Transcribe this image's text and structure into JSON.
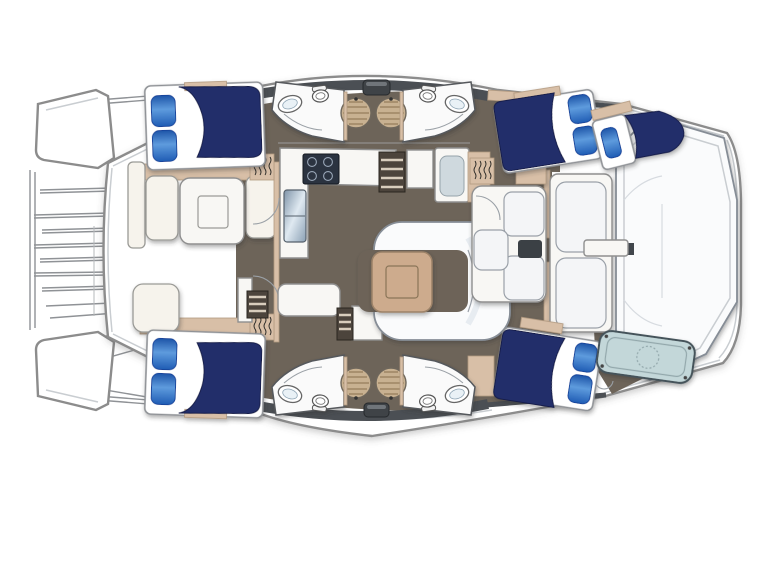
{
  "image": {
    "kind": "catamaran-deck-floor-plan",
    "width": 768,
    "height": 576,
    "background": "#ffffff",
    "orientation": "bow-left-stern-right"
  },
  "colors": {
    "outline_gray": "#8c8c8c",
    "inner_line": "#c9cdd1",
    "deck_band": "#4b4f54",
    "floor_taupe": "#6d6459",
    "wood_tan": "#d8bfa7",
    "table_tan": "#cdab8d",
    "bed_navy": "#232e6b",
    "pillow_blue": "#2f6fc4",
    "sofa_white": "#fafbfc",
    "shower_tan": "#c8b191",
    "steps_dark": "#4c443c",
    "stove_dark": "#2b3340",
    "tender_blue": "#c3d7d9",
    "cream": "#f6f3ec"
  },
  "areas": [
    {
      "id": "port-bow",
      "label": "port bow"
    },
    {
      "id": "starboard-bow",
      "label": "starboard bow"
    },
    {
      "id": "trampoline",
      "label": "bow trampoline"
    },
    {
      "id": "forward-cockpit",
      "label": "forward cockpit seating with table"
    },
    {
      "id": "galley",
      "label": "galley with stove, sink and fridge"
    },
    {
      "id": "dining-area",
      "label": "saloon dining with C-sofa and table"
    },
    {
      "id": "nav-seating",
      "label": "aft saloon seating"
    },
    {
      "id": "head-port-forward",
      "label": "bathroom port forward"
    },
    {
      "id": "head-starboard-forward",
      "label": "bathroom port aft"
    },
    {
      "id": "head-port-aft",
      "label": "bathroom starboard forward"
    },
    {
      "id": "head-starboard-aft",
      "label": "bathroom starboard aft"
    },
    {
      "id": "bed-forward-port",
      "label": "forward cabin berth (top left)"
    },
    {
      "id": "bed-forward-starboard",
      "label": "forward cabin berth (bottom left)"
    },
    {
      "id": "bed-aft-port",
      "label": "aft cabin berth (top right)"
    },
    {
      "id": "bed-skipper",
      "label": "skipper berth (far top right)"
    },
    {
      "id": "bed-aft-starboard",
      "label": "aft cabin berth (bottom right)"
    },
    {
      "id": "tender-platform",
      "label": "tender / engine hatch (bottom right)"
    },
    {
      "id": "cockpit-lounge",
      "label": "aft cockpit lounge"
    }
  ],
  "counts": {
    "double_berths": 4,
    "single_berths": 1,
    "heads": 4,
    "shower_pans": 4,
    "sinks": 4,
    "toilets": 4
  }
}
